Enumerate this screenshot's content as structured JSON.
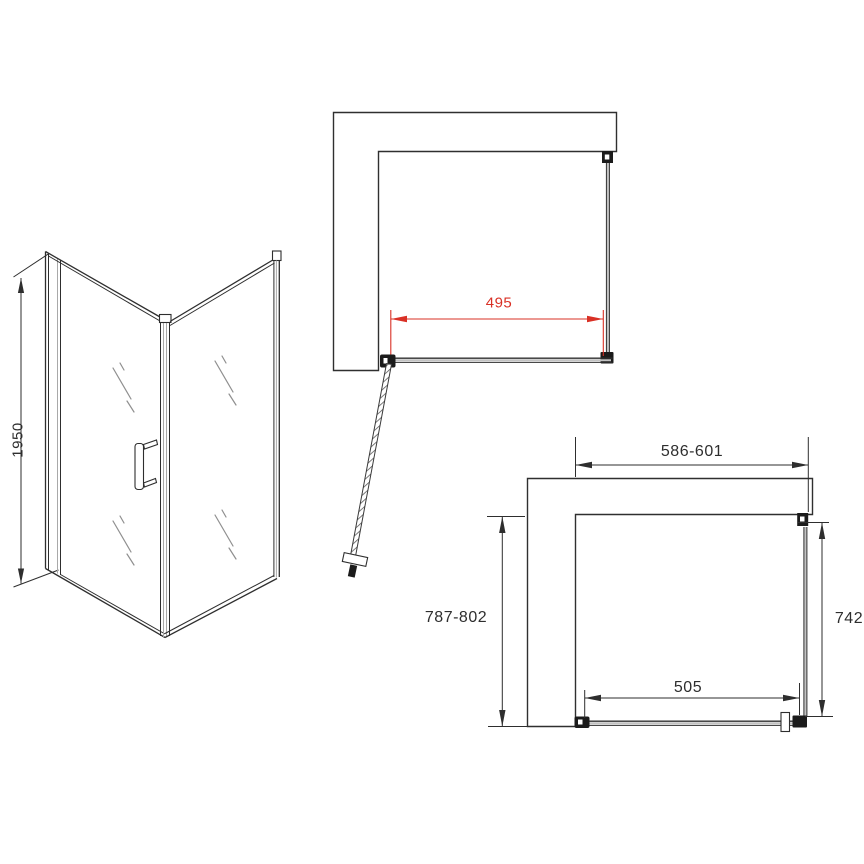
{
  "drawing": {
    "views": {
      "perspective": {
        "height_mm": "1950"
      },
      "door_open_plan": {
        "door_panel_width_mm": "495"
      },
      "installation_plan": {
        "overall_width_mm": "586-601",
        "overall_depth_mm": "787-802",
        "side_panel_mm": "742",
        "fixed_panel_mm": "505"
      }
    }
  },
  "colors": {
    "line": "#2e2e2e",
    "dimension_red": "#d93025",
    "glass_gray": "#a9a9a9"
  }
}
